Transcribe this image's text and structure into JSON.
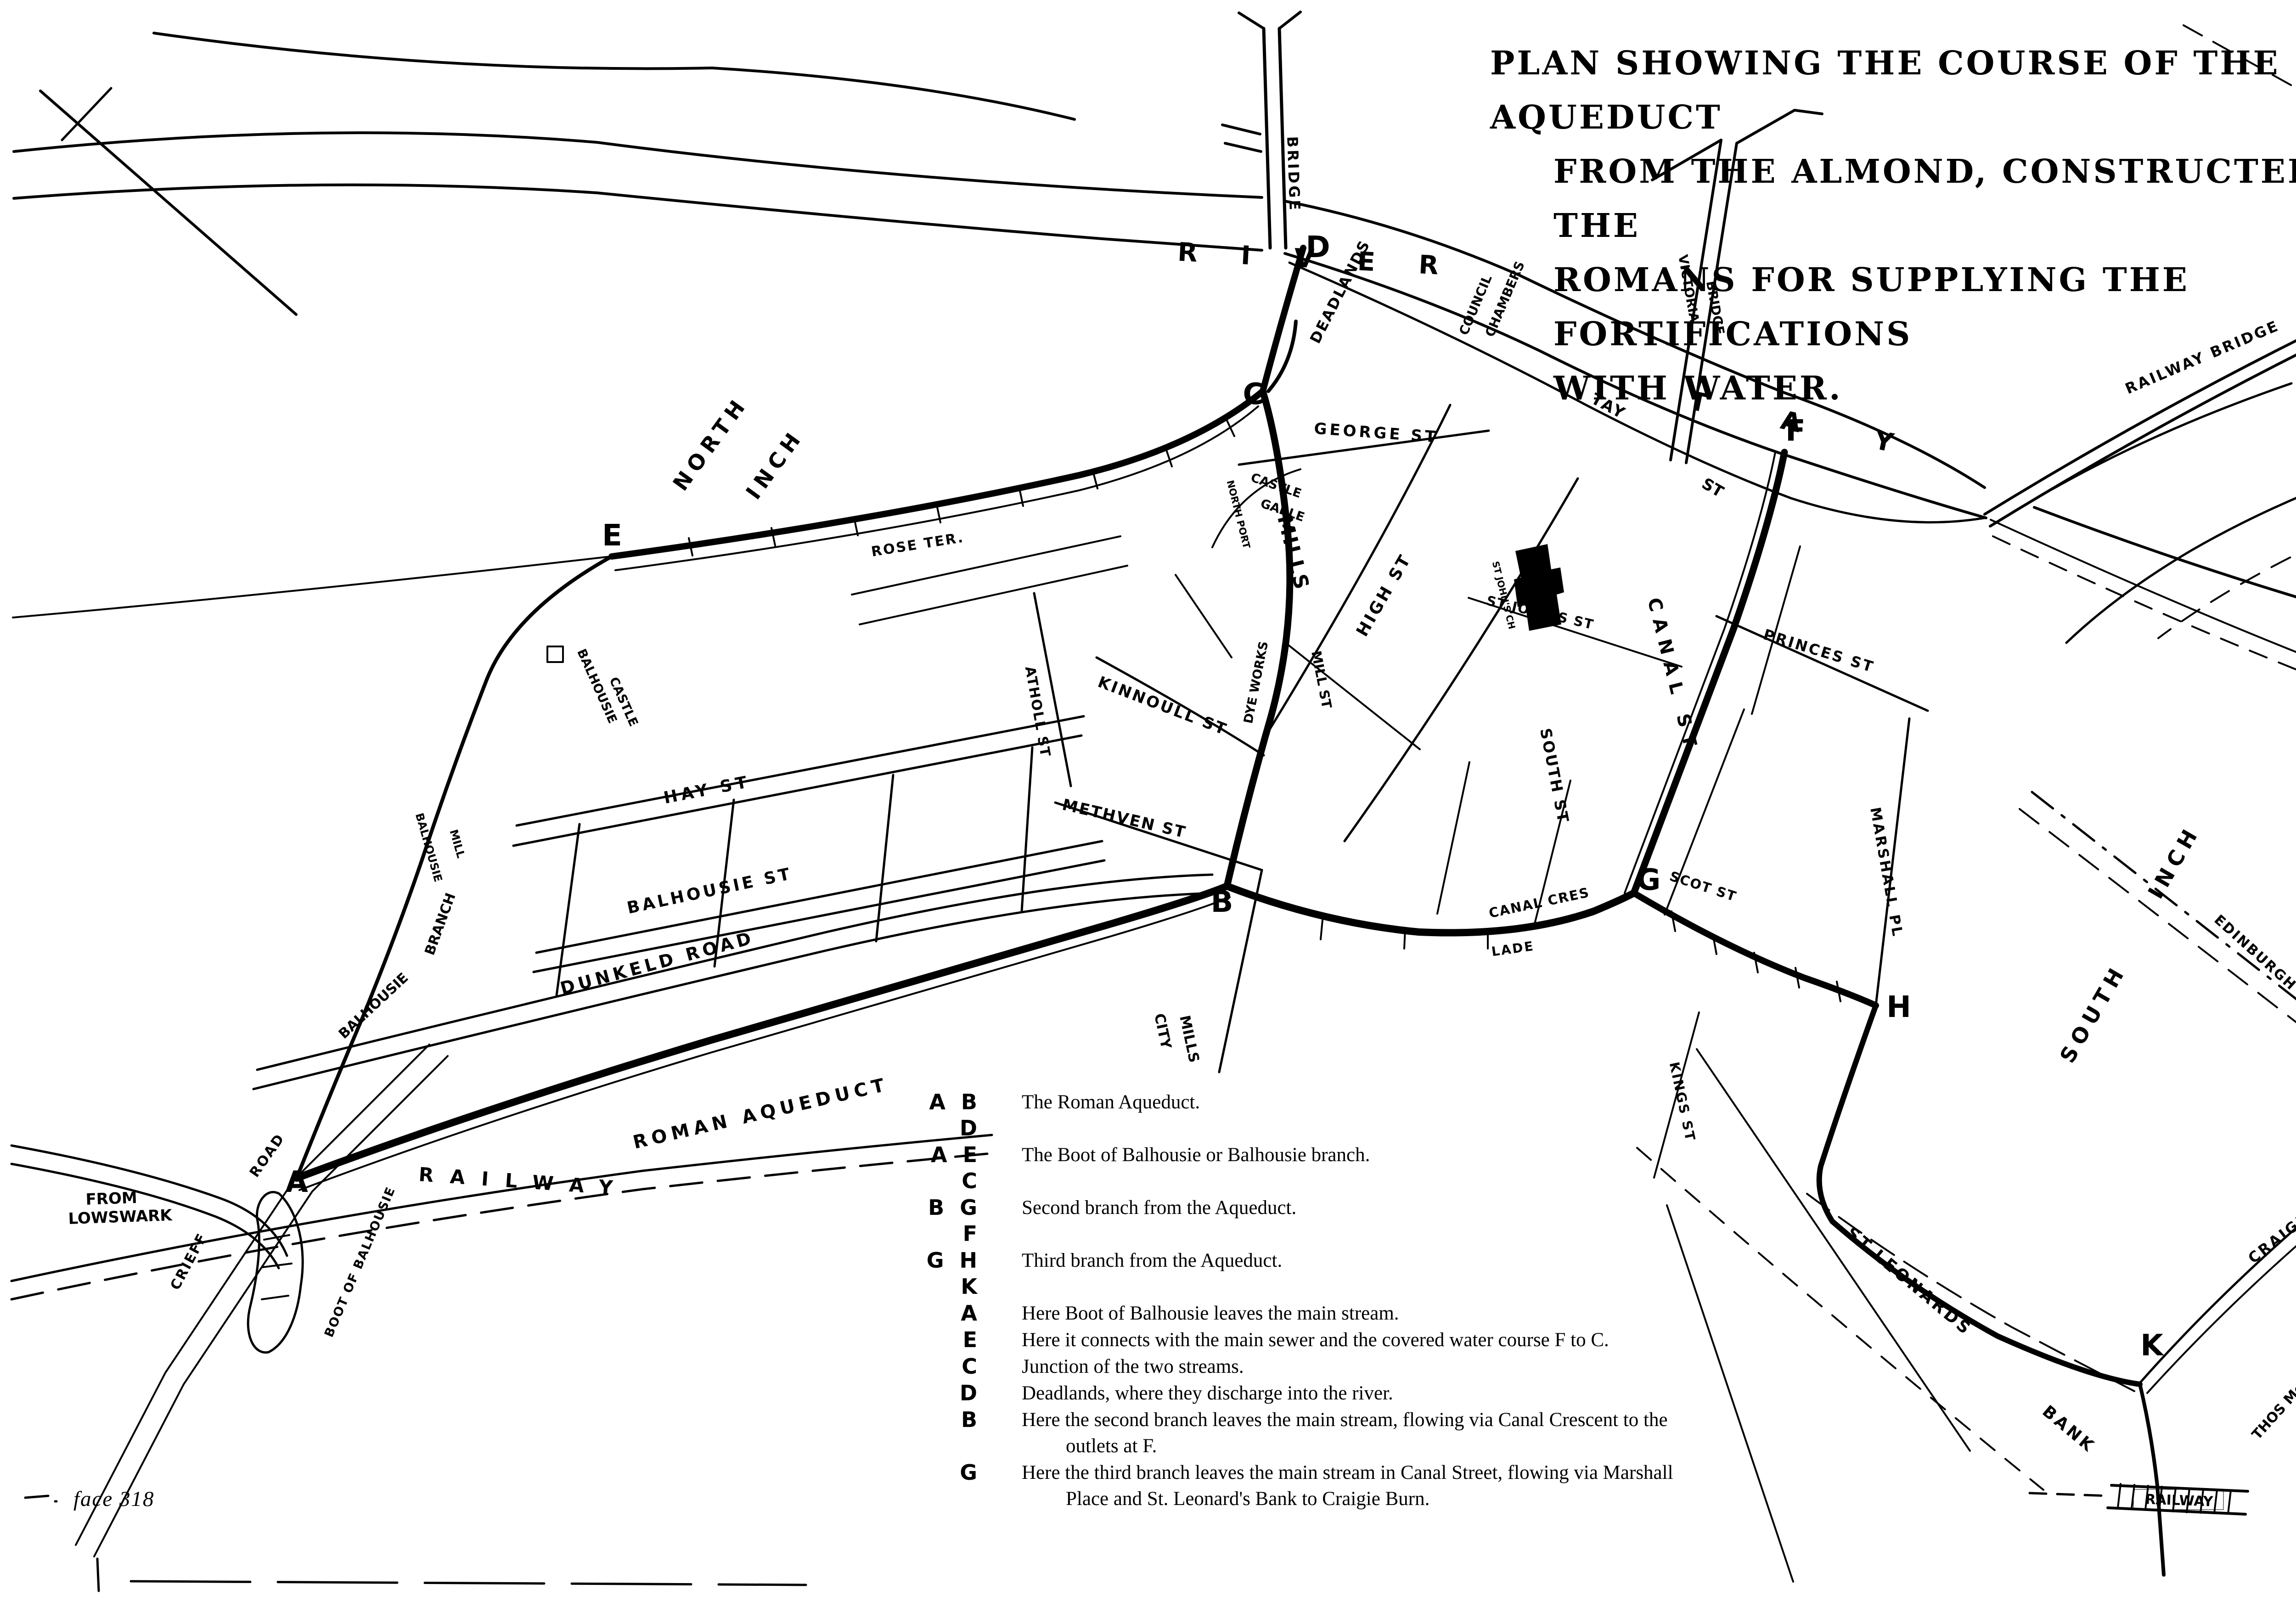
{
  "title": {
    "lines": [
      "PLAN SHOWING THE COURSE OF THE AQUEDUCT",
      "FROM THE ALMOND, CONSTRUCTED BY THE",
      "ROMANS FOR SUPPLYING THE FORTIFICATIONS",
      "WITH WATER."
    ]
  },
  "legend": {
    "rows": [
      {
        "codes": "A B D",
        "text": "The Roman Aqueduct."
      },
      {
        "codes": "A E C",
        "text": "The Boot of Balhousie or Balhousie branch."
      },
      {
        "codes": "B G F",
        "text": "Second branch from the Aqueduct."
      },
      {
        "codes": "G H K",
        "text": "Third branch from the Aqueduct."
      },
      {
        "codes": "A",
        "text": "Here Boot of Balhousie leaves the main stream."
      },
      {
        "codes": "E",
        "text": "Here it connects with the main sewer and the covered water course F to C."
      },
      {
        "codes": "C",
        "text": "Junction of the two streams."
      },
      {
        "codes": "D",
        "text": "Deadlands, where they discharge into the river."
      },
      {
        "codes": "B",
        "text": "Here the second branch leaves the main stream, flowing via Canal Crescent to the outlets at F."
      },
      {
        "codes": "G",
        "text": "Here the third branch leaves the main stream in Canal Street, flowing via Marshall Place and St. Leonard's Bank to Craigie Burn."
      }
    ]
  },
  "plate_note": "face 318",
  "signature": {
    "line1": "THOS McLAREN",
    "line2": "DEL"
  },
  "map": {
    "markers": {
      "a": "A",
      "b": "B",
      "c": "C",
      "d": "D",
      "e": "E",
      "f": "F",
      "g": "G",
      "h": "H",
      "k": "K"
    },
    "labels": {
      "river": "RIVER",
      "tay": "TAY",
      "perth_bridge": "BRIDGE",
      "deadlands": "DEADLANDS",
      "council_chambers_1": "COUNCIL",
      "council_chambers_2": "CHAMBERS",
      "victoria_bridge_1": "VICTORIA",
      "victoria_bridge_2": "BRIDGE",
      "railway_bridge": "RAILWAY BRIDGE",
      "north_inch_1": "NORTH",
      "north_inch_2": "INCH",
      "south_inch_1": "SOUTH",
      "south_inch_2": "INCH",
      "edinburgh_rd": "EDINBURGH RD",
      "craigie": "CRAIGIE",
      "st_leonards_bank_1": "ST.LEONARDS",
      "st_leonards_bank_2": "BANK",
      "railway_station": "RAILWAY",
      "railway_left": "RAILWAY",
      "from_lowswark_1": "FROM",
      "from_lowswark_2": "LOWSWARK",
      "crieff": "CRIEFF",
      "crieff_road": "ROAD",
      "boot_of_balhousie": "BOOT OF BALHOUSIE",
      "roman_aqueduct": "ROMAN AQUEDUCT",
      "dunkeld_road": "DUNKELD ROAD",
      "balhousie_branch_1": "BALHOUSIE",
      "balhousie_branch_2": "BRANCH",
      "balhousie_mill_1": "BALHOUSIE",
      "balhousie_mill_2": "MILL",
      "balhousie_castle_1": "BALHOUSIE",
      "balhousie_castle_2": "CASTLE",
      "hay_st": "HAY ST",
      "balhousie_st": "BALHOUSIE ST",
      "rose_ter": "ROSE TER.",
      "atholl_st": "ATHOLL ST",
      "kinnoull_st": "KINNOULL ST",
      "methven_st": "METHVEN ST",
      "george_st": "GEORGE ST",
      "castle_gable_1": "CASTLE",
      "castle_gable_2": "GABLE",
      "north_port": "NORTH PORT",
      "mills": "MILLS",
      "dye_works": "DYE WORKS",
      "mill_st": "MILL ST",
      "city_mills_1": "CITY",
      "city_mills_2": "MILLS",
      "high_st": "HIGH ST",
      "south_st": "SOUTH ST",
      "st_johns_st": "ST JOHN'S ST",
      "st_johns_ch": "ST JOHN'S CH",
      "tay_st_1": "TAY",
      "tay_st_2": "ST",
      "princes_st": "PRINCES ST",
      "canal_st": "CANAL ST",
      "canal_cres": "CANAL CRES",
      "lade": "LADE",
      "scot_st": "SCOT ST",
      "marshall_pl": "MARSHALL PL",
      "kings_st": "KINGS ST"
    }
  }
}
